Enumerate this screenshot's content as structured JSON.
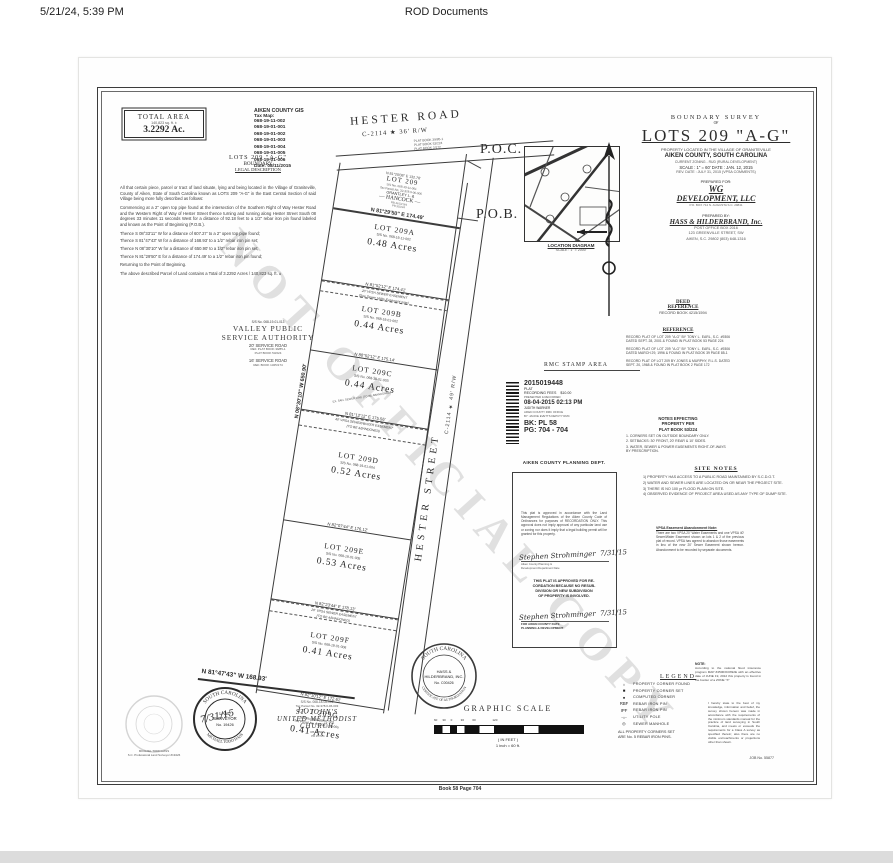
{
  "header": {
    "timestamp": "5/21/24, 5:39 PM",
    "title": "ROD Documents"
  },
  "footer": {
    "book_page": "Book 58 Page 704"
  },
  "colors": {
    "ink": "#2b2b2b",
    "watermark": "#d8d8d8"
  },
  "plat": {
    "watermark": "NOT OFFICIAL COPY",
    "total_area": {
      "label": "TOTAL AREA",
      "sqft": "140,823 sq. ft. ±",
      "acres": "3.2292  Ac."
    },
    "gis": {
      "title": "AIKEN COUNTY GIS",
      "label": "Tax Map:",
      "parcels": [
        "068-19-11-002",
        "068-19-01-001",
        "068-19-01-002",
        "068-19-01-003",
        "068-19-01-004",
        "068-19-01-005",
        "068-19-01-006"
      ],
      "date": "Date: 08/11/2015"
    },
    "legal": {
      "h1": "LOTS  209  \"A-G\"",
      "h2": "BOUNDARY",
      "h3": "LEGAL DESCRIPTION",
      "paragraphs": [
        "All that certain piece, parcel or tract of land situate, lying and being located in the Village of Graniteville, County of Aiken, State of South Carolina known as LOTS 209 \"A-G\" in the East Central Section of said Village being more fully described as follows:",
        "Commencing at a 2\" open top pipe found at the intersection of the Southern Right of Way Hester Road and the Western Right of Way of Hester Street thence turning and running along Hester Street South 08 degrees 33 minutes 11 seconds West for a distance of 92.18 feet to a 1/2\" rebar iron pin found labeled and known as the Point of Beginning (P.O.B.).",
        "Thence S 08°33'11\" W for a distance of 607.27' to a 2\" open top pipe found;",
        "Thence S 81°47'43\" W for a distance of 168.93' to a 1/2\" rebar iron pin set;",
        "Thence N 08°30'10\" W for a distance of 650.90' to a 1/2\" rebar iron pin set;",
        "Thence N 81°29'50\" E for a distance of 174.49' to a 1/2\" rebar iron pin found;",
        "Returning to the Point of Beginning.",
        "The above described Parcel of Land contains a Total of 3.2292 Acres / 140,823 sq. ft. ±"
      ]
    },
    "roads": {
      "hester_road": "HESTER  ROAD",
      "hester_road_rw": "C-2114  ★  36'  R/W",
      "road_refs": "PLAT BOOK 39/85-1\nPLAT BOOK 53/224\nPLAT BOOK 2/172",
      "hester_street": "HESTER  STREET",
      "hester_street_rw": "C-2114  ★  49'  R/W",
      "poc": "P.O.C.",
      "pob": "P.O.B."
    },
    "west_line": "N 08°30'10\" W      650.90'",
    "south_line": "N 81°47'43\" W        168.93'",
    "hancock": {
      "top_line": "N 81°20'08\" E    132.78'",
      "name": "LOT  209",
      "ss": "S/S No. 068-19-11-001",
      "tax": "Tax Parcel No. 32-378.0-06-006",
      "owner1": "GRANTLEY  L.  &",
      "owner2": "—  HANCOCK  —",
      "refs": "RB 4613/164\nPB 35/224",
      "bottom_line": "N 81°29'50\" E      174.49'"
    },
    "lots": [
      {
        "name": "LOT  209A",
        "ss": "S/S No. 068-19-11-002",
        "acres": "0.48   Acres",
        "line": "N 81°52'12\" E    174.41'"
      },
      {
        "name": "LOT  209B",
        "ss": "S/S No. 068-19-01-002",
        "acres": "0.44   Acres",
        "line": "N 80°52'12\" E    175.14'"
      },
      {
        "name": "LOT  209C",
        "ss": "S/S No. 068-19-01-003",
        "acres": "0.44   Acres",
        "line": "N 81°12'12\" E    175.56'"
      },
      {
        "name": "LOT  209D",
        "ss": "S/S No. 068-19-01-004",
        "acres": "0.52   Acres",
        "line": "N 82°07'44\" E    176.12'"
      },
      {
        "name": "LOT  209E",
        "ss": "S/S No. 068-19-01-005",
        "acres": "0.53   Acres",
        "line": "N 82°23'44\" E    178.13'"
      },
      {
        "name": "LOT  209F",
        "ss": "S/S No. 068-19-01-006",
        "acres": "0.41   Acres",
        "line": "N 82°10'12\" E    172.61'"
      },
      {
        "name": "LOT  209G",
        "ss": "S/S No. 068-19-01-001",
        "tax": "Tax Parcel No. 32-378.0-06-005",
        "acres": "0.41   Acres",
        "line": ""
      }
    ],
    "easements": {
      "ab1": "20' VPSA SEWER EASEMENT",
      "ab2": "(See Sewer Utility Easement note)",
      "cd1": "40' VPSA SEWER/WATER EASEMENT",
      "cd2": "(TO BE ABANDONED)",
      "ef1": "20' VPSA SEWER EASEMENT",
      "ef2": "(TO BE ABANDONED)",
      "lotc_note": "EX. SAN. SEWER LINE (TO BE ABANDONED)"
    },
    "valley": {
      "ss": "S/S No. 068-19-01-013",
      "name1": "VALLEY  PUBLIC",
      "name2": "SERVICE  AUTHORITY",
      "l1": "20' SERVICE ROAD",
      "l2": "REF. PLAT BOOK 39/85-1\nPLAT BOOK 53/224",
      "l3": "16' SERVICE ROAD",
      "l4": "REF. BOOK 1325/174"
    },
    "location_map": {
      "caption": "LOCATION  DIAGRAM",
      "scale": "SCALE : 1\" = 2000'"
    },
    "title_block": {
      "line1": "BOUNDARY  SURVEY",
      "line2": "OF",
      "title": "LOTS  209  \"A-G\"",
      "loc1": "PROPERTY LOCATED IN  THE  VILLAGE  OF  GRANITEVILLE",
      "loc2": "AIKEN  COUNTY,  SOUTH  CAROLINA",
      "zoning": "CURRENT ZONING - RUD (RURAL DEVELOPMENT)",
      "scale_date": "SCALE : 1\" = 60'     DATE : JAN. 12, 2015",
      "rev": "REV. DATE : JULY 31, 2015 (VPSA COMMENTS)",
      "prepared_for": "PREPARED FOR:",
      "client1": "WG",
      "client2": "DEVELOPMENT,  LLC",
      "client3": "P.O. BOX 714  N. AUGUSTA S.C. 29841",
      "prepared_by": "PREPARED BY:",
      "firm": "HASS  &  HILDERBRAND,  Inc.",
      "firm_addr": "POST OFFICE BOX 2016\n123 GREENVILLE STREET, SW\nAIKEN, S.C. 29802    (803) 648-1316"
    },
    "deed_ref": {
      "h1": "DEED",
      "h2": "REFERENCE",
      "body": "RECORD BOOK  4215/1594"
    },
    "reference": {
      "heading": "REFERENCE",
      "paragraphs": [
        "RECORD PLAT OF LOT 209 \"A-G\" BY TONY L. EARL, S.C. #9306 DATED SEPT. 28, 2001 & FOUND IN PLAT BOOK 53 PAGE 224",
        "RECORD PLAT OF LOT 209 \"A-G\" BY TONY L. EARL, S.C. #9306 DATED MARCH 29, 1996 & FOUND IN PLAT BOOK 39 PAGE 85-1",
        "RECORD PLAT OF LOT 209 BY JONES & MURPHY, R.L.S. DATED SEPT. 20, 1968 & FOUND IN PLAT BOOK 2 PAGE 172"
      ]
    },
    "notes_effecting": {
      "heading": "NOTES  EFFECTING\nPROPERTY  PER\nPLAT  BOOK  53/224",
      "items": [
        "1.  CORNERS  SET  ON  OUTSIDE BOUNDARY ONLY.",
        "2.  SETBACKS:  30' FRONT, 20' REAR  &  10'  SIDES.",
        "3.  WATER, SEWER & POWER EASEMENTS RIGHT-OF-WAYS BY  PRESCRIPTION."
      ]
    },
    "site_notes": {
      "heading": "SITE  NOTES",
      "items": [
        "1)  PROPERTY HAS ACCESS TO A PUBLIC ROAD MAINTAINED BY  S.C.D.O.T.",
        "2)  WATER AND SEWER LINES ARE LOCATED ON OR NEAR THE PROJECT SITE.",
        "3)  THERE IS NO 100 yr FLOOD PLAIN ON SITE.",
        "4)  OBSERVED EVIDENCE OF PROJECT AREA USED AS ANY TYPE OF DUMP SITE."
      ]
    },
    "vpsa_note": {
      "heading": "VPSA Easement Abandonment Note:",
      "body": "There are two VPSA 20' Water Easements and one VPSA 40' Sewer/Water Easement shown on lots 1 & 2 of the previous plat of record. VPSA has agreed to abandon those easements in lieu of the new 20' Sewer Easement shown hereon. Abandonment to be recorded by separate documents."
    },
    "rmc": {
      "area_label": "RMC  STAMP  AREA",
      "number": "2015019448",
      "doc_type": "PLAT",
      "fees": "RECORDING FEES",
      "fee_amount": "$10.00",
      "presented": "PRESENTED & RECORDED",
      "datetime": "08-04-2015 02:13 PM",
      "officer": "JUDITH WARNER",
      "office": "AIKEN COUNTY RMC OFFICE",
      "deputy": "BY: JACKIE EVETTS DEPUTY RMC",
      "bk": "BK: PL 58",
      "pg": "PG: 704 - 704"
    },
    "planning": {
      "heading": "AIKEN  COUNTY  PLANNING  DEPT.",
      "body": "This plat is approved in accordance with the Land Management Regulations of the Aiken County Code of Ordinances for purposes of RECORDATION ONLY. This approval does not imply approval of any particular land use or zoning nor does it imply that a legal building permit will be granted for this property.",
      "sig1_name": "Stephen Strohminger",
      "sig1_date": "7/31/15",
      "sig1_caption": "Aiken County Planning &\nDevelopment Department                Date",
      "approval": "THIS PLAT IS APPROVED FOR RE-\nCORDATION BECAUSE NO RESUB-\nDIVISION OR NEW SUBDIVISION\nOF PROPERTY IS INVOLVED.",
      "sig2_name": "Stephen Strohminger",
      "sig2_date": "7/31/15",
      "sig2_caption": "FOR  AIKEN  COUNTY                    DATE\nPLANNING & DEVELOPMENT"
    },
    "legend": {
      "heading": "LEGEND",
      "items": [
        {
          "sym": "○",
          "label": "PROPERTY  CORNER  FOUND"
        },
        {
          "sym": "■",
          "label": "PROPERTY  CORNER  SET"
        },
        {
          "sym": "●",
          "label": "COMPUTED  CORNER"
        },
        {
          "sym": "RBF",
          "label": "REBAR  IRON  PIN"
        },
        {
          "sym": "IPF",
          "label": "REBAR  IRON  PIN"
        },
        {
          "sym": "-○-",
          "label": "UTILITY  POLE"
        },
        {
          "sym": "◎",
          "label": "SEWER  MANHOLE"
        }
      ],
      "footnote": "ALL PROPERTY CORNERS SET\nARE No. 5 REBAR IRON PINS."
    },
    "flood_note": {
      "heading": "NOTE:",
      "body": "According to the national flood insurance program MAP #45003C0392E with an effective date of JUNE 19, 2012 this property is found in the border of a ZONE \"X\""
    },
    "certification": "I hereby state to the best of my knowledge, information and belief, the survey shown hereon was made in accordance with the requirements of the minimum standards manual for the practice of land surveying in South Carolina, and meets or exceeds the requirements for a Class A survey as specified therein; also there are no visible encroachments or projections other than shown.",
    "job_no": "JOB No. 55877",
    "graphic_scale": {
      "heading": "GRAPHIC  SCALE",
      "ticks": "60      30      0          30          60                    120",
      "in_feet": "( IN FEET )",
      "inch": "1 inch  =  60   ft."
    },
    "auth_seal": {
      "arc_top": "SOUTH  CAROLINA",
      "arc_bottom": "CERTIFICATE OF AUTHORIZATION",
      "line1": "HASS &",
      "line2": "HILDERBRAND, INC.",
      "line3": "No. C00426"
    },
    "surveyor_seal": {
      "arc_top": "SOUTH  CAROLINA",
      "arc_bottom": "MICHAEL  TODD  HASS",
      "line1": "LAND",
      "line2": "SURVEYOR",
      "line3": "No. 19426",
      "sig_date": "7/31/15"
    },
    "embossed_caption": "MICHAEL TODD HASS\nS.C. Professional Land Surveyor #19426",
    "church": {
      "ss": "S/S No. 068-18-08-001",
      "tax": "Tax Parcel No. 32-378.0-06-003",
      "name1": "ST.  JOHN'S",
      "name2": "UNITED  METHODIST",
      "name3": "CHURCH",
      "refs": "RB 38/504\nPB 2/172"
    }
  }
}
